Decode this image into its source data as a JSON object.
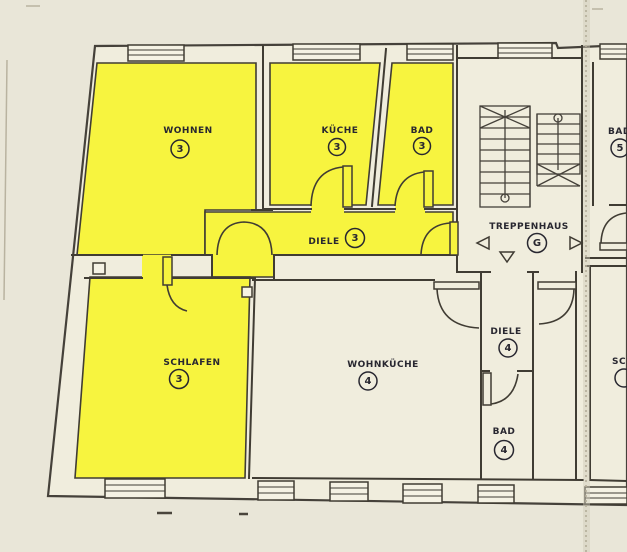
{
  "drawing_type": "apartment-floor-plan",
  "colors": {
    "highlight": "#f7f43f",
    "building": "#f0eddd",
    "page": "#e9e6d8",
    "wall": "#403c33",
    "text": "#282730"
  },
  "rooms": {
    "wohnen": {
      "label": "WOHNEN",
      "unit": "3"
    },
    "kueche": {
      "label": "KÜCHE",
      "unit": "3"
    },
    "bad_3": {
      "label": "BAD",
      "unit": "3"
    },
    "diele_3": {
      "label": "DIELE",
      "unit": "3"
    },
    "schlafen": {
      "label": "SCHLAFEN",
      "unit": "3"
    },
    "wohnkueche": {
      "label": "WOHNKÜCHE",
      "unit": "4"
    },
    "diele_4": {
      "label": "DIELE",
      "unit": "4"
    },
    "bad_4": {
      "label": "BAD",
      "unit": "4"
    },
    "treppenhaus": {
      "label": "TREPPENHAUS",
      "unit": "G"
    },
    "bad_5": {
      "label": "BAD",
      "unit": "5"
    },
    "schlafen_5": {
      "label": "SCH",
      "unit": ""
    }
  }
}
